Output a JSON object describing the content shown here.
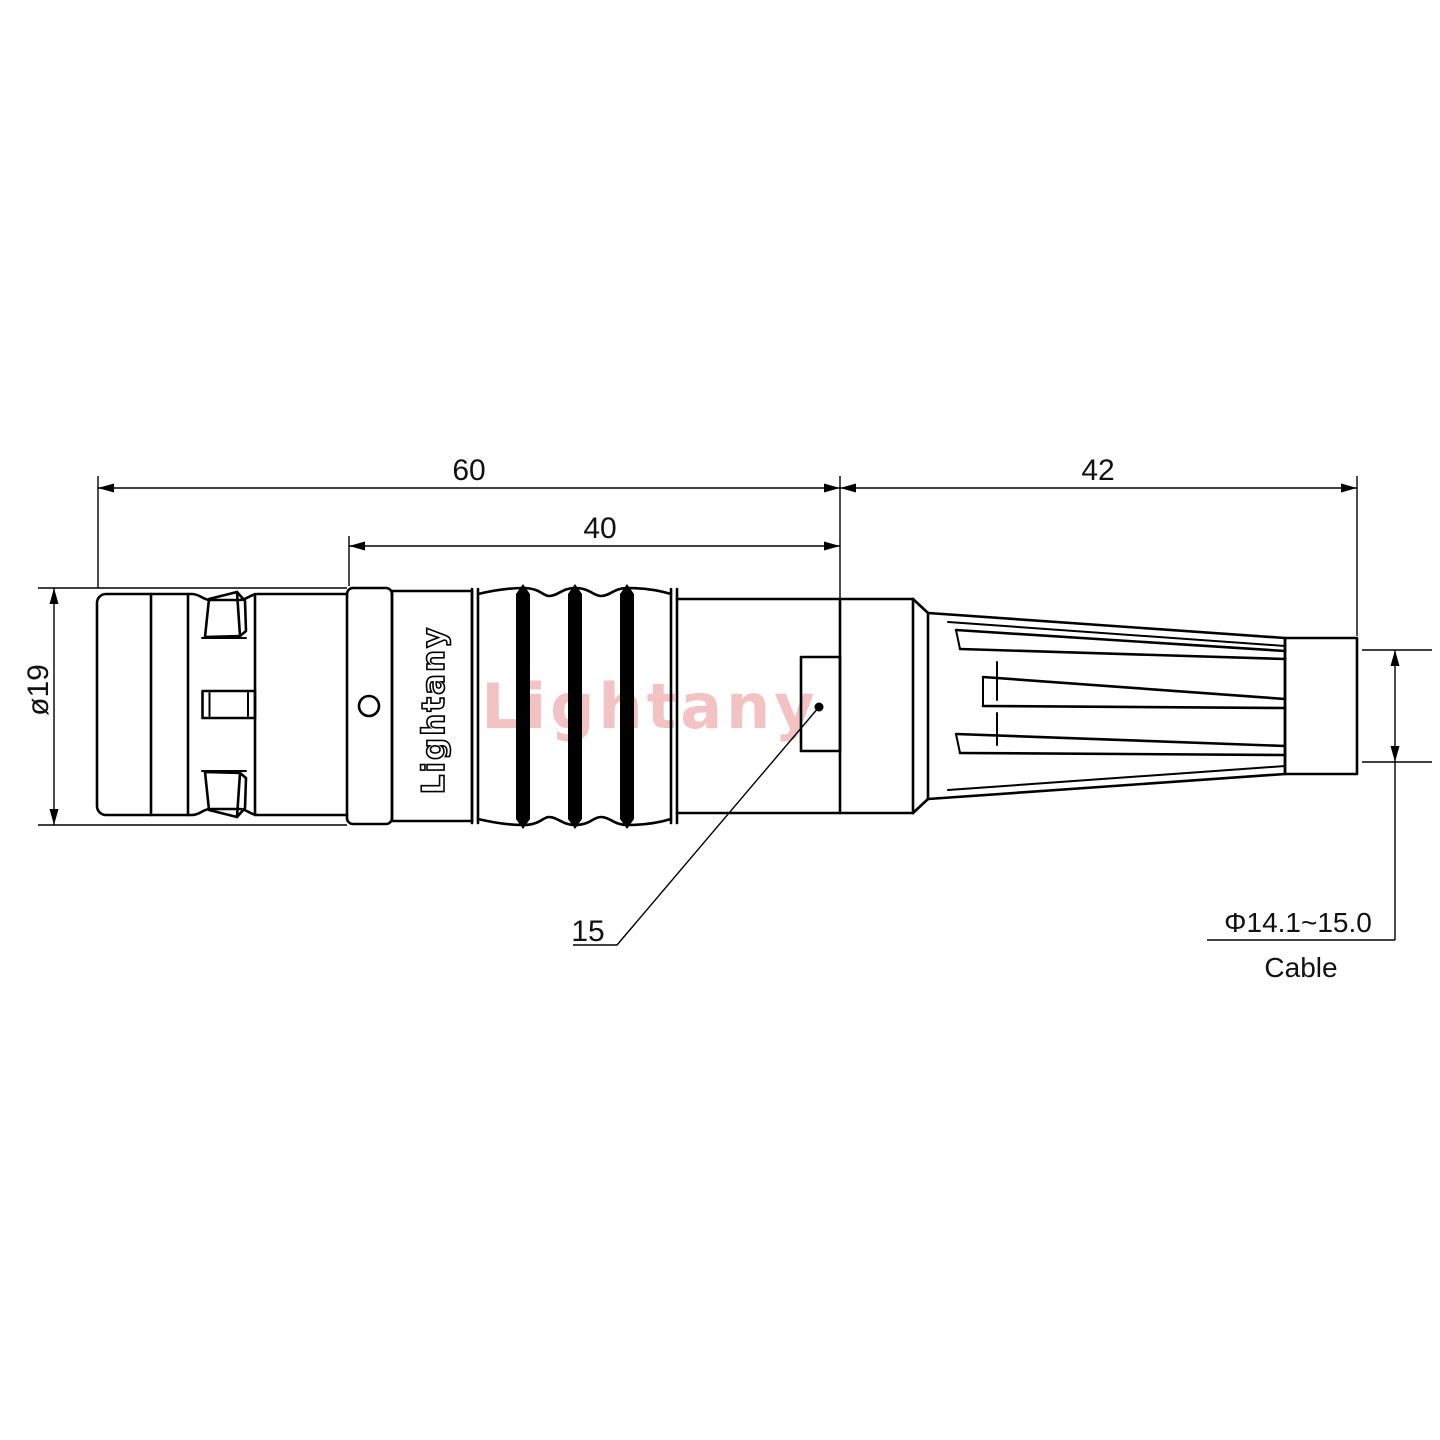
{
  "drawing": {
    "background_color": "#ffffff",
    "line_color": "#000000",
    "brand_engraving": "Lightany",
    "watermark": {
      "text": "Lightany",
      "color": "#efb0b0"
    },
    "dimensions": {
      "overall_length": "60",
      "rear_length": "42",
      "body_length": "40",
      "shell_diameter": "ø19",
      "clamp_feature": "15",
      "cable_diameter_range": "Φ14.1~15.0",
      "cable_label": "Cable"
    }
  }
}
